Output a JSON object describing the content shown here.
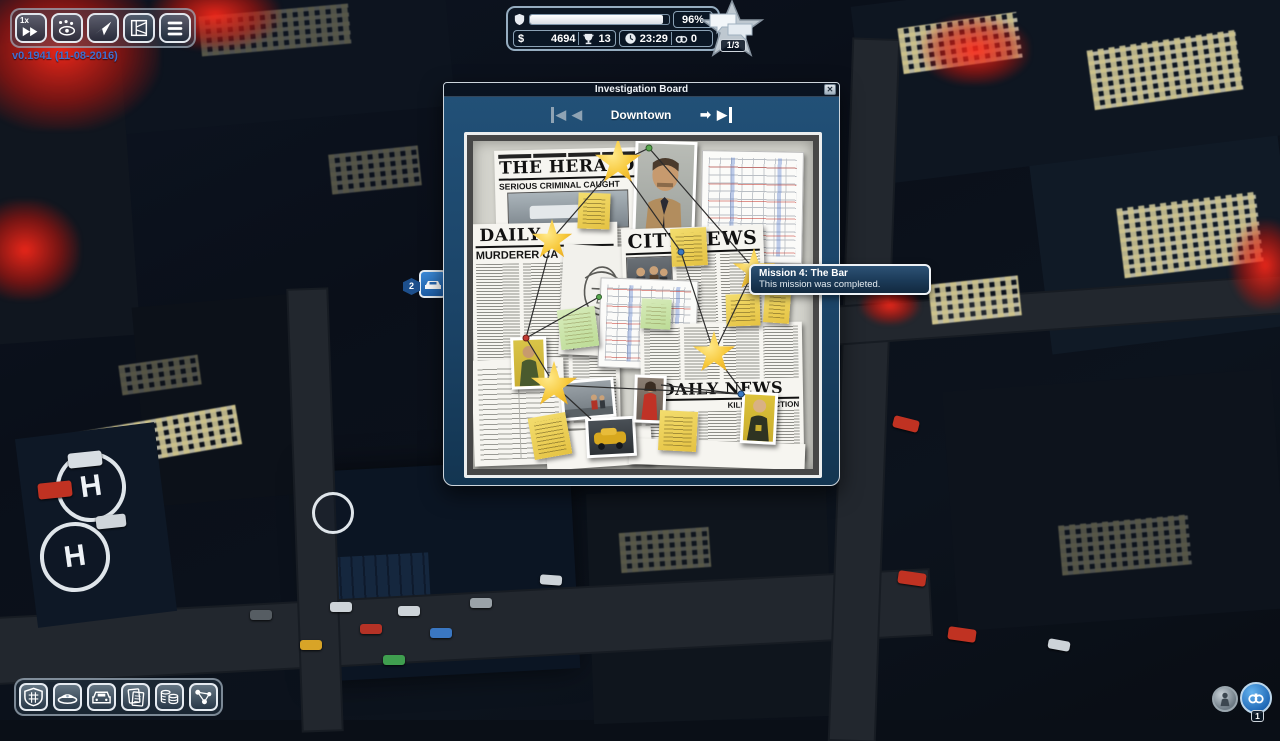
{
  "version_label": "v0.1941 (11-08-2016)",
  "top_toolbar": {
    "speed_label": "1x",
    "icons": [
      "fast-forward-icon",
      "patrol-eye-icon",
      "navigation-arrow-icon",
      "district-map-icon",
      "task-list-icon"
    ]
  },
  "hud": {
    "reputation_percent": "96%",
    "reputation_fill_style": "width:96%",
    "money_symbol": "$",
    "money": "4694",
    "trophies": "13",
    "time": "23:29",
    "arrests": "0",
    "missions_badge": "1/3",
    "icons": [
      "shield-icon",
      "dollar-icon",
      "trophy-icon",
      "clock-icon",
      "handcuffs-icon",
      "star-speech-badge-icon"
    ]
  },
  "dialog": {
    "title": "Investigation Board",
    "close_glyph": "✕",
    "nav": {
      "first_glyph": "◀",
      "prev_glyph": "◀",
      "district": "Downtown",
      "next_glyph": "➡",
      "last_glyph": "▶"
    },
    "board": {
      "newspapers": {
        "herald_masthead": "THE HERALD",
        "herald_headline": "SERIOUS CRIMINAL CAUGHT",
        "daily_masthead": "DAILY",
        "daily_headline": "MURDERER CA",
        "city_news_masthead": "CITY NEWS",
        "daily_news_masthead": "DAILY NEWS",
        "daily_news_headline": "KILLED IN ACTION"
      },
      "mission_stars_count": 5
    }
  },
  "tooltip": {
    "title": "Mission 4: The Bar",
    "body": "This mission was completed."
  },
  "map": {
    "patrol_marker_count": "2",
    "helipad_label": "H"
  },
  "bottom_toolbar": {
    "icons": [
      "precinct-shield-icon",
      "police-cap-icon",
      "police-car-icon",
      "case-files-icon",
      "finances-icon",
      "criminal-network-icon"
    ]
  },
  "bottom_right": {
    "arrest_count": "1",
    "icons": [
      "civilian-icon",
      "handcuffs-icon"
    ]
  },
  "colors": {
    "accent_blue": "#1b4468",
    "star_gold": "#f7c93c",
    "alert_red": "#d42718",
    "note_yellow": "#eed45e",
    "note_green": "#cce3a8"
  }
}
